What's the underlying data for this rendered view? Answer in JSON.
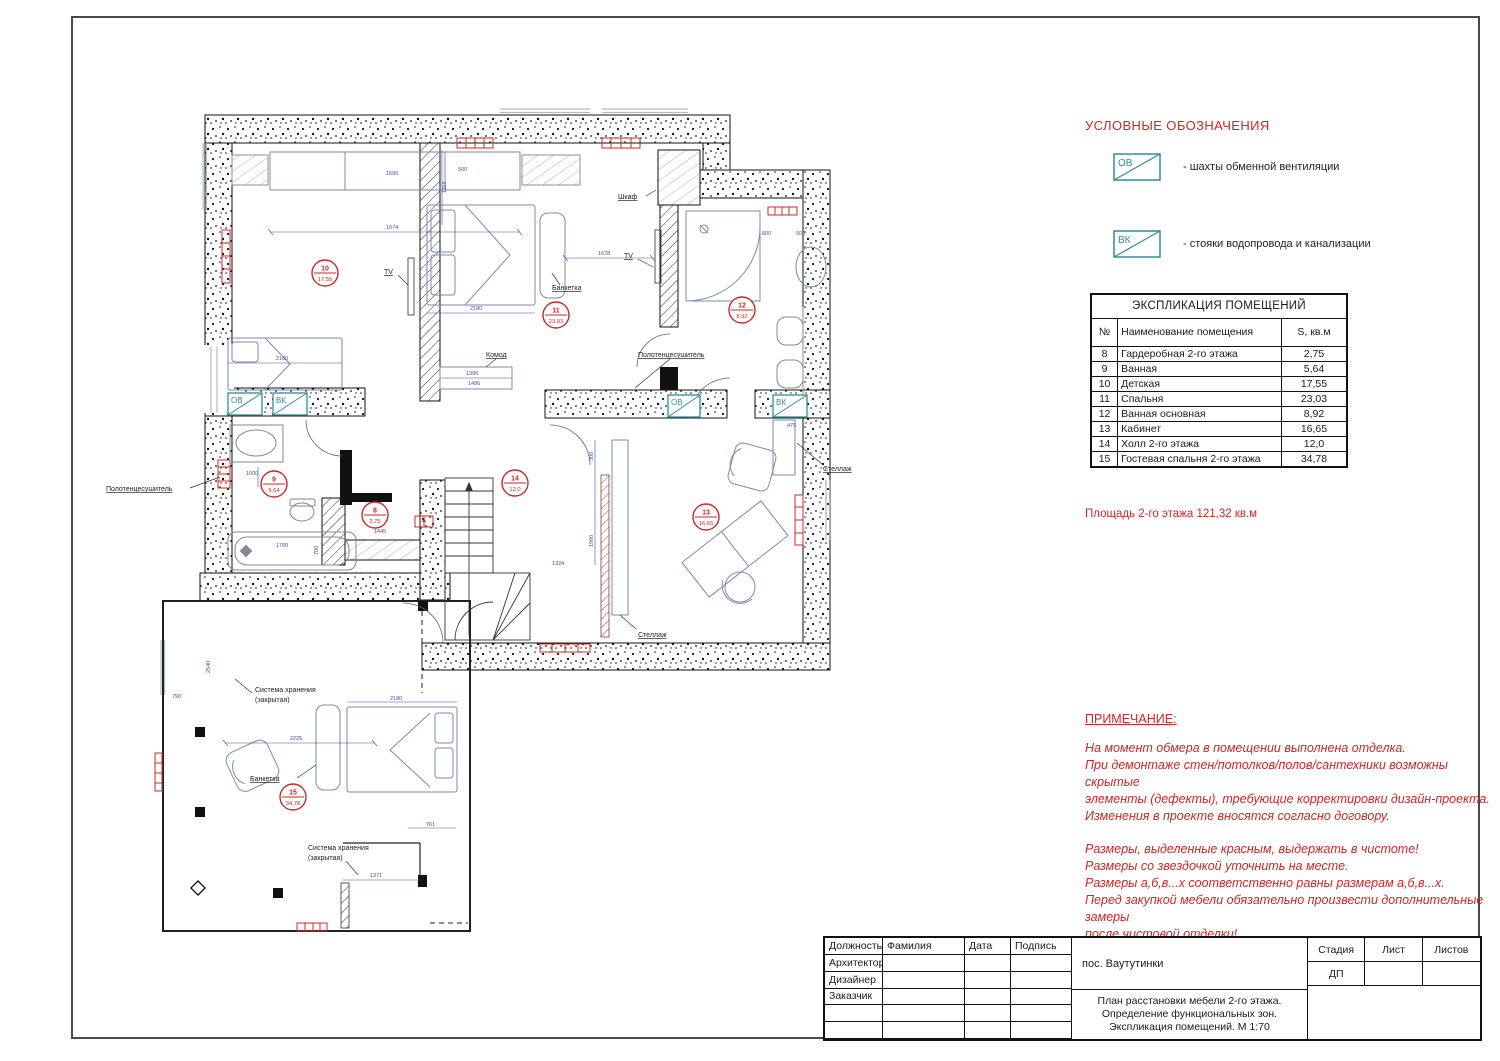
{
  "legend": {
    "title": "УСЛОВНЫЕ ОБОЗНАЧЕНИЯ",
    "ov": "ОВ",
    "vk": "ВК",
    "item_ov": "- шахты обменной вентиляции",
    "item_vk": "- стояки водопровода и канализации",
    "item_el": "- электрический щит"
  },
  "explication": {
    "title": "ЭКСПЛИКАЦИЯ ПОМЕЩЕНИЙ",
    "col_num": "№",
    "col_name": "Наименование помещения",
    "col_area": "S, кв.м",
    "rows": [
      [
        "8",
        "Гардеробная 2-го этажа",
        "2,75"
      ],
      [
        "9",
        "Ванная",
        "5,64"
      ],
      [
        "10",
        "Детская",
        "17,55"
      ],
      [
        "11",
        "Спальня",
        "23,03"
      ],
      [
        "12",
        "Ванная основная",
        "8,92"
      ],
      [
        "13",
        "Кабинет",
        "16,65"
      ],
      [
        "14",
        "Холл 2-го этажа",
        "12,0"
      ],
      [
        "15",
        "Гостевая спальня 2-го этажа",
        "34,78"
      ]
    ]
  },
  "area_note": "Площадь 2-го этажа 121,32 кв.м",
  "notes": {
    "title": "ПРИМЕЧАНИЕ:",
    "para1": [
      "На момент обмера в помещении выполнена отделка.",
      "При демонтаже стен/потолков/полов/сантехники возможны скрытые",
      "элементы (дефекты), требующие корректировки дизайн-проекта.",
      "Изменения в проекте вносятся согласно договору."
    ],
    "para2": [
      "Размеры, выделенные красным, выдержать в чистоте!",
      "Размеры со звездочкой уточнить на месте.",
      "Размеры а,б,в...х соответственно равны размерам а,б,в...х.",
      "Перед закупкой мебели обязательно произвести дополнительные замеры",
      "после чистовой отделки!"
    ]
  },
  "titleblock": {
    "col1": "Должность",
    "col2": "Фамилия",
    "col3": "Дата",
    "col4": "Подпись",
    "row1": "Архитектор",
    "row2": "Дизайнер",
    "row3": "Заказчик",
    "project": "пос. Ваутутинки",
    "sheet_title1": "План расстановки мебели 2-го этажа.",
    "sheet_title2": "Определение функциональных зон.",
    "sheet_title3": "Экспликация помещений. М 1:70",
    "stage_label": "Стадия",
    "list_label": "Лист",
    "lists_label": "Листов",
    "stage_value": "ДП"
  },
  "plan": {
    "rooms": [
      {
        "number": "10",
        "area": "17,55"
      },
      {
        "number": "11",
        "area": "23,03"
      },
      {
        "number": "12",
        "area": "8,92"
      },
      {
        "number": "9",
        "area": "5,64"
      },
      {
        "number": "8",
        "area": "2,75"
      },
      {
        "number": "14",
        "area": "12,0"
      },
      {
        "number": "13",
        "area": "16,65"
      },
      {
        "number": "15",
        "area": "34,78"
      }
    ],
    "labels": {
      "tv": "TV",
      "wardrobe": "Шкаф",
      "dresser": "Комод",
      "bench": "Банкетка",
      "shelf": "Стеллаж",
      "towel_rail": "Полотенцесушитель",
      "storage_line1": "Система хранения",
      "storage_line2": "(закрытая)",
      "ov": "ОВ",
      "vk": "ВК"
    },
    "dims": [
      "1674",
      "1600",
      "2180",
      "2180",
      "1678",
      "1118",
      "500",
      "800",
      "500",
      "1000",
      "1700",
      "700",
      "1445",
      "1300",
      "300",
      "1900",
      "1324",
      "475",
      "2225",
      "2180",
      "790",
      "2540",
      "1371",
      "761",
      "1486"
    ]
  }
}
